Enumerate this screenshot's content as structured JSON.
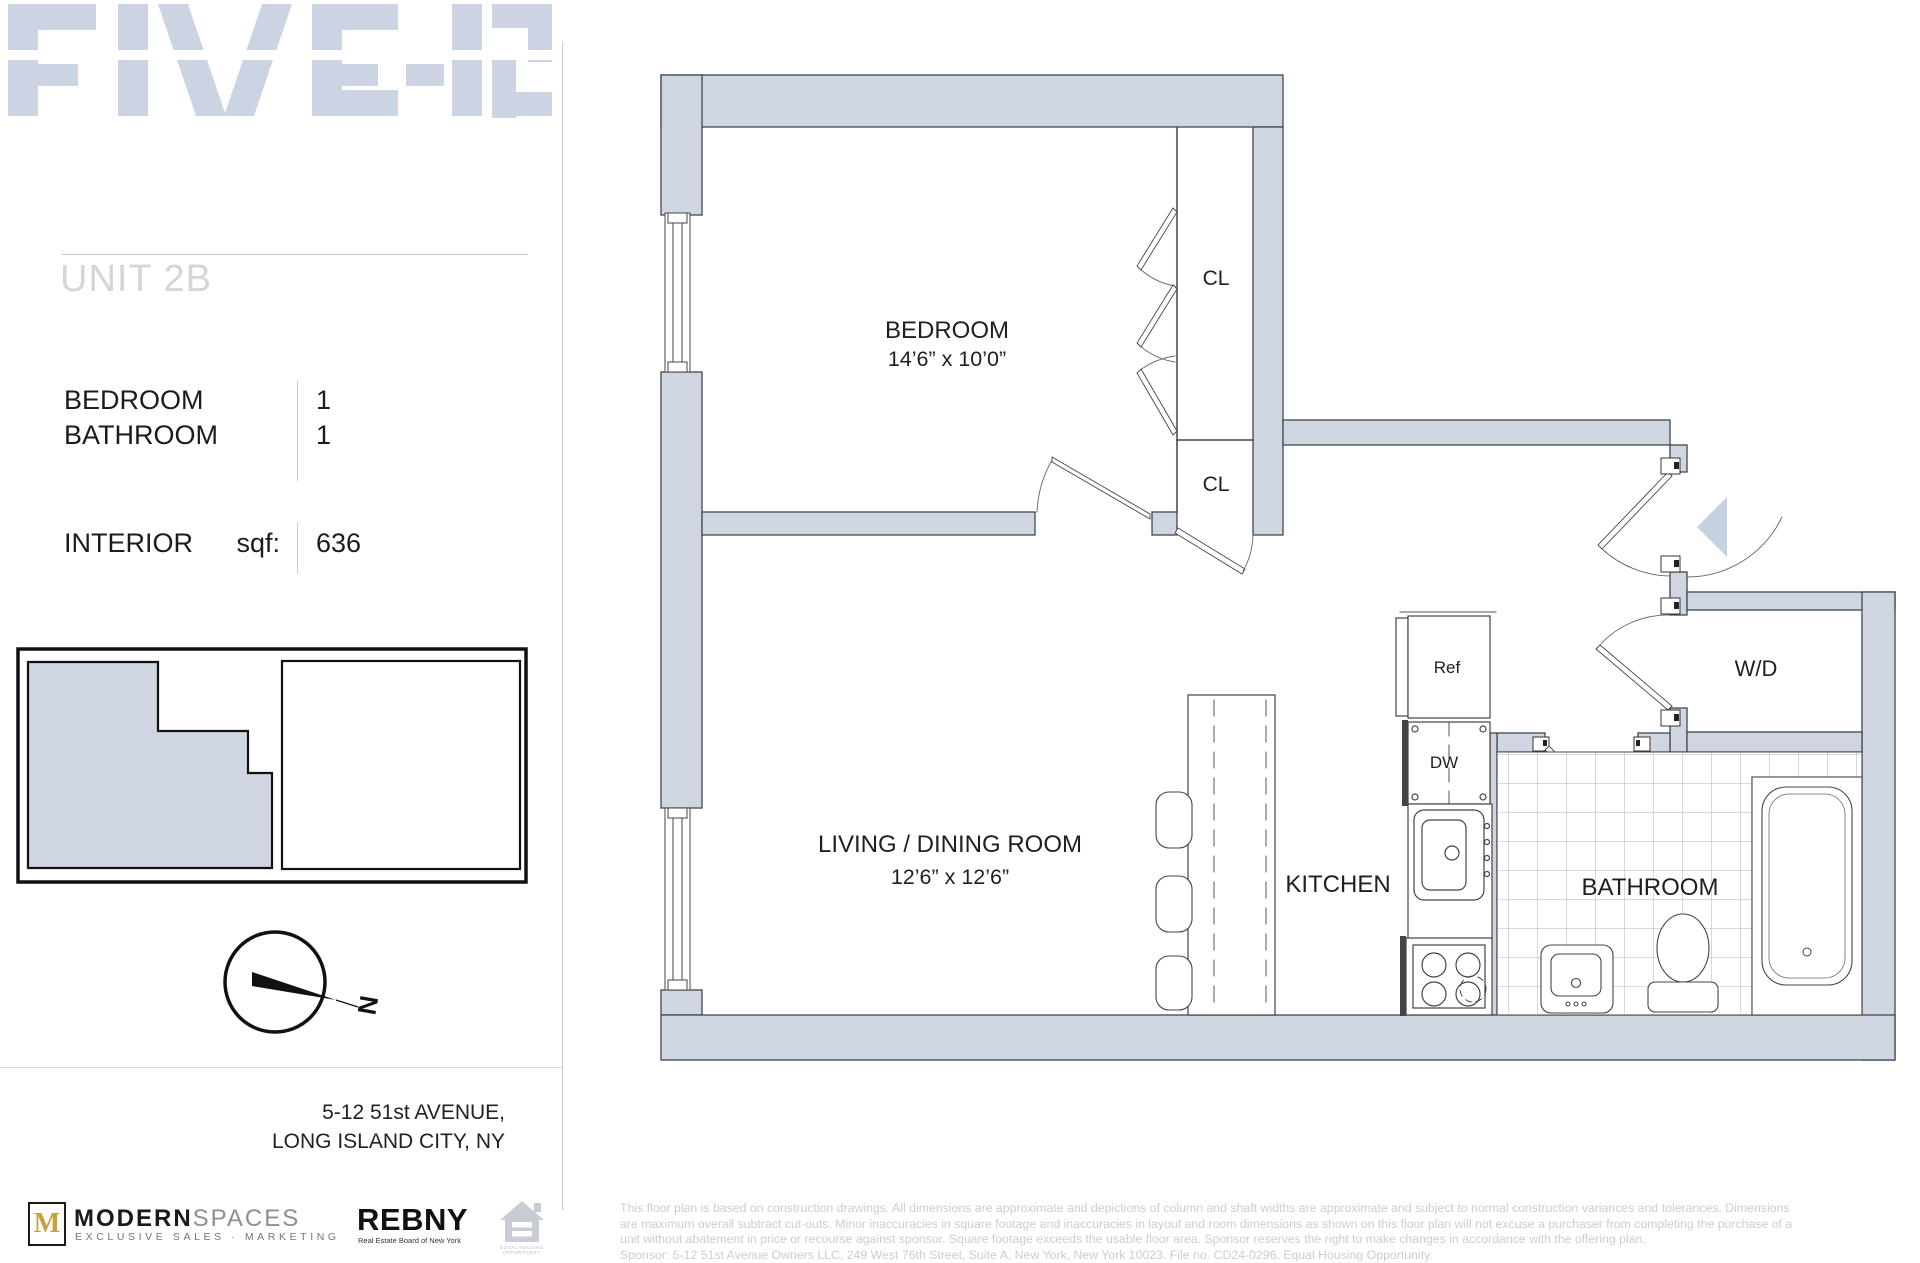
{
  "brand": {
    "logo_text": "FIVE-12"
  },
  "sidebar": {
    "unit_title": "UNIT 2B",
    "stats": [
      {
        "label": "BEDROOM",
        "value": "1"
      },
      {
        "label": "BATHROOM",
        "value": "1"
      }
    ],
    "interior": {
      "label": "INTERIOR",
      "unit_label": "sqf:",
      "value": "636"
    },
    "compass_label": "N",
    "address_line1": "5-12 51st AVENUE,",
    "address_line2": "LONG ISLAND CITY, NY"
  },
  "floorplan": {
    "bedroom": {
      "name": "BEDROOM",
      "dims": "14’6” x 10’0”"
    },
    "living": {
      "name": "LIVING / DINING ROOM",
      "dims": "12’6” x 12’6”"
    },
    "kitchen": {
      "name": "KITCHEN"
    },
    "bathroom": {
      "name": "BATHROOM"
    },
    "closet_upper": "CL",
    "closet_lower": "CL",
    "fridge": "Ref",
    "dishwasher": "DW",
    "washer_dryer": "W/D",
    "colors": {
      "wall_fill": "#cfd6e2",
      "watermark": "#ccd3e2",
      "accent_gold": "#c6a13c"
    }
  },
  "footer_logos": {
    "modernspaces": {
      "monogram": "M",
      "name_bold": "MODERN",
      "name_light": "SPACES",
      "tagline": "EXCLUSIVE SALES · MARKETING"
    },
    "rebny": {
      "name": "REBNY",
      "tagline": "Real Estate Board of New York"
    },
    "equal_housing": {
      "label": "EQUAL HOUSING OPPORTUNITY"
    }
  },
  "disclaimer": {
    "lines": [
      "This floor plan is based on construction drawings. All dimensions are approximate and depictions of column and shaft widths are approximate and subject to normal construction variances and tolerances. Dimensions",
      "are maximum overall subtract cut-outs. Minor inaccuracies in square footage and inaccuracies in layout and room dimensions as shown on this floor plan will not excuse a purchaser from completing the purchase of a",
      "unit without abatement in price or recourse against sponsor. Square footage exceeds the usable floor area. Sponsor reserves the right to make changes in accordance with the offering plan.",
      "Sponsor: 5-12 51st Avenue Owners LLC, 249 West 76th Street, Suite A, New York, New York 10023. File no. CD24-0296. Equal Housing Opportunity."
    ]
  }
}
